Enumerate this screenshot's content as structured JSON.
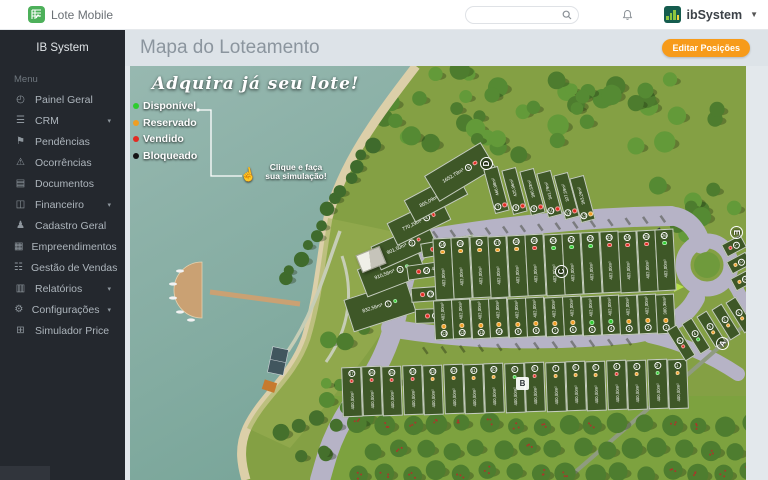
{
  "topbar": {
    "logo": "Lote Mobile",
    "brand": "ibSystem",
    "search": {
      "value": "",
      "placeholder": ""
    }
  },
  "sidebar": {
    "header": "IB System",
    "menu_label": "Menu",
    "items": [
      {
        "label": "Painel Geral",
        "icon": "dashboard-icon",
        "glyph": "◴",
        "caret": false
      },
      {
        "label": "CRM",
        "icon": "crm-icon",
        "glyph": "☰",
        "caret": true
      },
      {
        "label": "Pendências",
        "icon": "flag-file-icon",
        "glyph": "⚑",
        "caret": false
      },
      {
        "label": "Ocorrências",
        "icon": "warning-icon",
        "glyph": "⚠",
        "caret": false
      },
      {
        "label": "Documentos",
        "icon": "document-icon",
        "glyph": "▤",
        "caret": false
      },
      {
        "label": "Financeiro",
        "icon": "money-icon",
        "glyph": "◫",
        "caret": true
      },
      {
        "label": "Cadastro Geral",
        "icon": "users-icon",
        "glyph": "♟",
        "caret": false
      },
      {
        "label": "Empreendimentos",
        "icon": "building-icon",
        "glyph": "▦",
        "caret": false
      },
      {
        "label": "Gestão de Vendas",
        "icon": "sales-list-icon",
        "glyph": "☷",
        "caret": false
      },
      {
        "label": "Relatórios",
        "icon": "report-icon",
        "glyph": "▥",
        "caret": true
      },
      {
        "label": "Configurações",
        "icon": "gear-icon",
        "glyph": "⚙",
        "caret": true
      },
      {
        "label": "Simulador Price",
        "icon": "calculator-icon",
        "glyph": "⊞",
        "caret": false
      }
    ]
  },
  "page": {
    "title": "Mapa do Loteamento",
    "edit_button": "Editar Posições",
    "accent_color": "#f79b1a"
  },
  "map": {
    "banner": "Adquira já seu lote!",
    "cta": {
      "line1": "Clique e faça",
      "line2": "sua simulação!"
    },
    "legend": [
      {
        "label": "Disponível",
        "status": "disponivel",
        "color": "#2ecc2e"
      },
      {
        "label": "Reservado",
        "status": "reservado",
        "color": "#f09e22"
      },
      {
        "label": "Vendido",
        "status": "vendido",
        "color": "#e22b22"
      },
      {
        "label": "Bloqueado",
        "status": "bloqueado",
        "color": "#141414"
      }
    ],
    "status_colors": {
      "disponivel": "#2ecc2e",
      "reservado": "#f09e22",
      "vendido": "#e22b22",
      "bloqueado": "#141414"
    },
    "blocks": [
      {
        "label": "D",
        "x": 356,
        "y": 97,
        "rot": -90,
        "shape": "circle"
      },
      {
        "label": "C",
        "x": 431,
        "y": 205,
        "rot": -90,
        "shape": "circle"
      },
      {
        "label": "B",
        "x": 392,
        "y": 317,
        "rot": 0,
        "shape": "square"
      },
      {
        "label": "A",
        "x": 592,
        "y": 277,
        "rot": -60,
        "shape": "circle"
      },
      {
        "label": "E",
        "x": 606,
        "y": 166,
        "rot": 90,
        "shape": "circle"
      }
    ],
    "lots": [
      {
        "b": "D",
        "n": "1",
        "t": "dh",
        "x": 250,
        "y": 240,
        "w": 66,
        "h": 34,
        "r": -18,
        "a": "832,56m²",
        "s": "disponivel"
      },
      {
        "b": "D",
        "n": "2",
        "t": "dh",
        "x": 262,
        "y": 206,
        "w": 64,
        "h": 30,
        "r": -21,
        "a": "910,56m²",
        "s": "disponivel"
      },
      {
        "b": "D",
        "n": "3",
        "t": "dh",
        "x": 274,
        "y": 180,
        "w": 62,
        "h": 26,
        "r": -24,
        "a": "901,50m²",
        "s": "vendido"
      },
      {
        "b": "D",
        "n": "4",
        "t": "dh",
        "x": 289,
        "y": 155,
        "w": 60,
        "h": 25,
        "r": -26,
        "a": "770,29m²",
        "s": "vendido"
      },
      {
        "b": "D",
        "n": "5",
        "t": "dh",
        "x": 306,
        "y": 131,
        "w": 60,
        "h": 25,
        "r": -28,
        "a": "865,09m²",
        "s": "vendido"
      },
      {
        "b": "D",
        "n": "6",
        "t": "dh",
        "x": 330,
        "y": 106,
        "w": 66,
        "h": 30,
        "r": -31,
        "a": "1652,79m²",
        "s": "vendido"
      },
      {
        "b": "D",
        "n": "7",
        "t": "dv",
        "x": 366,
        "y": 124,
        "w": 15,
        "h": 46,
        "r": -15,
        "a": "466,98m²",
        "s": "vendido"
      },
      {
        "b": "D",
        "n": "8",
        "t": "dv",
        "x": 384,
        "y": 125,
        "w": 15,
        "h": 46,
        "r": -15,
        "a": "425,96m²",
        "s": "vendido"
      },
      {
        "b": "D",
        "n": "9",
        "t": "dv",
        "x": 402,
        "y": 126,
        "w": 15,
        "h": 46,
        "r": -15,
        "a": "390,53m²",
        "s": "vendido"
      },
      {
        "b": "D",
        "n": "10",
        "t": "dv",
        "x": 419,
        "y": 128,
        "w": 15,
        "h": 46,
        "r": -15,
        "a": "341,79m²",
        "s": "vendido"
      },
      {
        "b": "D",
        "n": "11",
        "t": "dv",
        "x": 436,
        "y": 130,
        "w": 15,
        "h": 46,
        "r": -15,
        "a": "327,59m²",
        "s": "vendido"
      },
      {
        "b": "D",
        "n": "12",
        "t": "dv",
        "x": 452,
        "y": 133,
        "w": 15,
        "h": 46,
        "r": -15,
        "a": "353,29m²",
        "s": "reservado"
      },
      {
        "b": "D",
        "n": "15",
        "t": "di",
        "x": 318,
        "y": 180,
        "w": 54,
        "h": 15,
        "r": -10,
        "a": "494,20m²",
        "s": "vendido"
      },
      {
        "b": "D",
        "n": "14",
        "t": "di",
        "x": 304,
        "y": 203,
        "w": 54,
        "h": 15,
        "r": -8,
        "a": "410,03m²",
        "s": "vendido"
      },
      {
        "b": "D",
        "n": "13",
        "t": "di",
        "x": 308,
        "y": 227,
        "w": 54,
        "h": 15,
        "r": -4,
        "a": "437,43m²",
        "s": "vendido"
      },
      {
        "b": "D",
        "n": "",
        "t": "di",
        "x": 312,
        "y": 249,
        "w": 54,
        "h": 15,
        "r": -2,
        "a": "545,4m²",
        "s": "vendido"
      },
      {
        "b": "C",
        "n": "14",
        "t": "ct",
        "x": 313,
        "y": 203,
        "w": 19,
        "h": 62,
        "r": -3,
        "a": "402,00m²",
        "s": "reservado"
      },
      {
        "b": "C",
        "n": "15",
        "t": "ct",
        "x": 331,
        "y": 202,
        "w": 19,
        "h": 62,
        "r": -3,
        "a": "402,00m²",
        "s": "reservado"
      },
      {
        "b": "C",
        "n": "16",
        "t": "ct",
        "x": 350,
        "y": 201,
        "w": 19,
        "h": 62,
        "r": -3,
        "a": "402,00m²",
        "s": "reservado"
      },
      {
        "b": "C",
        "n": "17",
        "t": "ct",
        "x": 368,
        "y": 201,
        "w": 19,
        "h": 62,
        "r": -3,
        "a": "402,00m²",
        "s": "reservado"
      },
      {
        "b": "C",
        "n": "18",
        "t": "ct",
        "x": 387,
        "y": 200,
        "w": 19,
        "h": 62,
        "r": -3,
        "a": "402,00m²",
        "s": "reservado"
      },
      {
        "b": "C",
        "n": "19",
        "t": "ct",
        "x": 405,
        "y": 199,
        "w": 19,
        "h": 62,
        "r": -3,
        "a": "402,00m²",
        "s": "vendido"
      },
      {
        "b": "C",
        "n": "20",
        "t": "ct",
        "x": 424,
        "y": 199,
        "w": 19,
        "h": 62,
        "r": -3,
        "a": "402,00m²",
        "s": "disponivel"
      },
      {
        "b": "C",
        "n": "21",
        "t": "ct",
        "x": 442,
        "y": 198,
        "w": 19,
        "h": 62,
        "r": -3,
        "a": "402,00m²",
        "s": "disponivel"
      },
      {
        "b": "C",
        "n": "22",
        "t": "ct",
        "x": 461,
        "y": 197,
        "w": 19,
        "h": 62,
        "r": -3,
        "a": "402,00m²",
        "s": "disponivel"
      },
      {
        "b": "C",
        "n": "23",
        "t": "ct",
        "x": 480,
        "y": 196,
        "w": 19,
        "h": 62,
        "r": -3,
        "a": "402,00m²",
        "s": "vendido"
      },
      {
        "b": "C",
        "n": "24",
        "t": "ct",
        "x": 498,
        "y": 196,
        "w": 19,
        "h": 62,
        "r": -3,
        "a": "402,00m²",
        "s": "vendido"
      },
      {
        "b": "C",
        "n": "25",
        "t": "ct",
        "x": 517,
        "y": 195,
        "w": 19,
        "h": 62,
        "r": -3,
        "a": "402,00m²",
        "s": "vendido"
      },
      {
        "b": "C",
        "n": "26",
        "t": "ct",
        "x": 535,
        "y": 194,
        "w": 19,
        "h": 62,
        "r": -3,
        "a": "402,00m²",
        "s": "disponivel"
      },
      {
        "b": "C",
        "n": "13",
        "t": "cb",
        "x": 313,
        "y": 254,
        "w": 19,
        "h": 40,
        "r": -3,
        "a": "402,00m²",
        "s": "reservado"
      },
      {
        "b": "C",
        "n": "12",
        "t": "cb",
        "x": 331,
        "y": 253,
        "w": 19,
        "h": 40,
        "r": -3,
        "a": "402,00m²",
        "s": "reservado"
      },
      {
        "b": "C",
        "n": "11",
        "t": "cb",
        "x": 350,
        "y": 253,
        "w": 19,
        "h": 40,
        "r": -3,
        "a": "402,00m²",
        "s": "reservado"
      },
      {
        "b": "C",
        "n": "10",
        "t": "cb",
        "x": 368,
        "y": 252,
        "w": 19,
        "h": 40,
        "r": -3,
        "a": "402,00m²",
        "s": "reservado"
      },
      {
        "b": "C",
        "n": "9",
        "t": "cb",
        "x": 387,
        "y": 252,
        "w": 19,
        "h": 40,
        "r": -3,
        "a": "402,00m²",
        "s": "reservado"
      },
      {
        "b": "C",
        "n": "8",
        "t": "cb",
        "x": 405,
        "y": 251,
        "w": 19,
        "h": 40,
        "r": -3,
        "a": "402,00m²",
        "s": "reservado"
      },
      {
        "b": "C",
        "n": "7",
        "t": "cb",
        "x": 424,
        "y": 251,
        "w": 19,
        "h": 40,
        "r": -3,
        "a": "402,00m²",
        "s": "reservado"
      },
      {
        "b": "C",
        "n": "6",
        "t": "cb",
        "x": 442,
        "y": 250,
        "w": 19,
        "h": 40,
        "r": -3,
        "a": "402,00m²",
        "s": "reservado"
      },
      {
        "b": "C",
        "n": "5",
        "t": "cb",
        "x": 461,
        "y": 250,
        "w": 19,
        "h": 40,
        "r": -3,
        "a": "402,00m²",
        "s": "disponivel"
      },
      {
        "b": "C",
        "n": "4",
        "t": "cb",
        "x": 480,
        "y": 249,
        "w": 19,
        "h": 40,
        "r": -3,
        "a": "402,00m²",
        "s": "disponivel"
      },
      {
        "b": "C",
        "n": "3",
        "t": "cb",
        "x": 498,
        "y": 249,
        "w": 19,
        "h": 40,
        "r": -3,
        "a": "402,00m²",
        "s": "reservado"
      },
      {
        "b": "C",
        "n": "2",
        "t": "cb",
        "x": 517,
        "y": 248,
        "w": 19,
        "h": 40,
        "r": -3,
        "a": "402,00m²",
        "s": "reservado"
      },
      {
        "b": "C",
        "n": "1",
        "t": "cb",
        "x": 535,
        "y": 248,
        "w": 19,
        "h": 40,
        "r": -3,
        "a": "380,36m²",
        "s": "reservado"
      },
      {
        "b": "B",
        "n": "1",
        "t": "b",
        "x": 548,
        "y": 318,
        "w": 20,
        "h": 50,
        "r": -2,
        "a": "400,00m²",
        "s": "reservado"
      },
      {
        "b": "B",
        "n": "2",
        "t": "b",
        "x": 528,
        "y": 318,
        "w": 20,
        "h": 50,
        "r": -2,
        "a": "400,00m²",
        "s": "disponivel"
      },
      {
        "b": "B",
        "n": "3",
        "t": "b",
        "x": 507,
        "y": 319,
        "w": 20,
        "h": 50,
        "r": -2,
        "a": "400,00m²",
        "s": "reservado"
      },
      {
        "b": "B",
        "n": "4",
        "t": "b",
        "x": 487,
        "y": 319,
        "w": 20,
        "h": 50,
        "r": -2,
        "a": "400,00m²",
        "s": "vendido"
      },
      {
        "b": "B",
        "n": "5",
        "t": "b",
        "x": 466,
        "y": 320,
        "w": 20,
        "h": 50,
        "r": -2,
        "a": "400,00m²",
        "s": "reservado"
      },
      {
        "b": "B",
        "n": "6",
        "t": "b",
        "x": 446,
        "y": 320,
        "w": 20,
        "h": 50,
        "r": -2,
        "a": "400,00m²",
        "s": "reservado"
      },
      {
        "b": "B",
        "n": "7",
        "t": "b",
        "x": 426,
        "y": 321,
        "w": 20,
        "h": 50,
        "r": -2,
        "a": "400,00m²",
        "s": "reservado"
      },
      {
        "b": "B",
        "n": "8",
        "t": "b",
        "x": 405,
        "y": 321,
        "w": 20,
        "h": 50,
        "r": -2,
        "a": "400,00m²",
        "s": "vendido"
      },
      {
        "b": "B",
        "n": "9",
        "t": "b",
        "x": 385,
        "y": 322,
        "w": 20,
        "h": 50,
        "r": -2,
        "a": "400,00m²",
        "s": "disponivel"
      },
      {
        "b": "B",
        "n": "10",
        "t": "b",
        "x": 364,
        "y": 322,
        "w": 20,
        "h": 50,
        "r": -2,
        "a": "400,00m²",
        "s": "reservado"
      },
      {
        "b": "B",
        "n": "11",
        "t": "b",
        "x": 344,
        "y": 323,
        "w": 20,
        "h": 50,
        "r": -2,
        "a": "400,00m²",
        "s": "reservado"
      },
      {
        "b": "B",
        "n": "12",
        "t": "b",
        "x": 324,
        "y": 323,
        "w": 20,
        "h": 50,
        "r": -2,
        "a": "400,00m²",
        "s": "reservado"
      },
      {
        "b": "B",
        "n": "13",
        "t": "b",
        "x": 303,
        "y": 324,
        "w": 20,
        "h": 50,
        "r": -2,
        "a": "400,00m²",
        "s": "reservado"
      },
      {
        "b": "B",
        "n": "14",
        "t": "b",
        "x": 283,
        "y": 324,
        "w": 20,
        "h": 50,
        "r": -2,
        "a": "400,00m²",
        "s": "vendido"
      },
      {
        "b": "B",
        "n": "15",
        "t": "b",
        "x": 262,
        "y": 325,
        "w": 20,
        "h": 50,
        "r": -2,
        "a": "400,00m²",
        "s": "vendido"
      },
      {
        "b": "B",
        "n": "16",
        "t": "b",
        "x": 242,
        "y": 325,
        "w": 20,
        "h": 50,
        "r": -2,
        "a": "400,00m²",
        "s": "vendido"
      },
      {
        "b": "B",
        "n": "17",
        "t": "b",
        "x": 222,
        "y": 326,
        "w": 20,
        "h": 50,
        "r": -2,
        "a": "400,00m²",
        "s": "vendido"
      },
      {
        "b": "A",
        "n": "5",
        "t": "a",
        "x": 551,
        "y": 277,
        "w": 12,
        "h": 36,
        "r": -32,
        "a": "",
        "s": "vendido"
      },
      {
        "b": "A",
        "n": "4",
        "t": "a",
        "x": 566,
        "y": 270,
        "w": 12,
        "h": 36,
        "r": -32,
        "a": "",
        "s": "disponivel"
      },
      {
        "b": "A",
        "n": "3",
        "t": "a",
        "x": 581,
        "y": 263,
        "w": 12,
        "h": 36,
        "r": -32,
        "a": "",
        "s": "reservado"
      },
      {
        "b": "A",
        "n": "2",
        "t": "a",
        "x": 596,
        "y": 256,
        "w": 12,
        "h": 36,
        "r": -32,
        "a": "",
        "s": "reservado"
      },
      {
        "b": "A",
        "n": "1",
        "t": "a",
        "x": 610,
        "y": 249,
        "w": 12,
        "h": 36,
        "r": -32,
        "a": "",
        "s": "reservado"
      },
      {
        "b": "E",
        "n": "1",
        "t": "e",
        "x": 604,
        "y": 180,
        "w": 14,
        "h": 22,
        "r": 62,
        "a": "",
        "s": "vendido"
      },
      {
        "b": "E",
        "n": "2",
        "t": "e",
        "x": 609,
        "y": 197,
        "w": 14,
        "h": 22,
        "r": 62,
        "a": "",
        "s": "reservado"
      },
      {
        "b": "E",
        "n": "3",
        "t": "e",
        "x": 613,
        "y": 214,
        "w": 14,
        "h": 22,
        "r": 62,
        "a": "",
        "s": "reservado"
      }
    ]
  }
}
